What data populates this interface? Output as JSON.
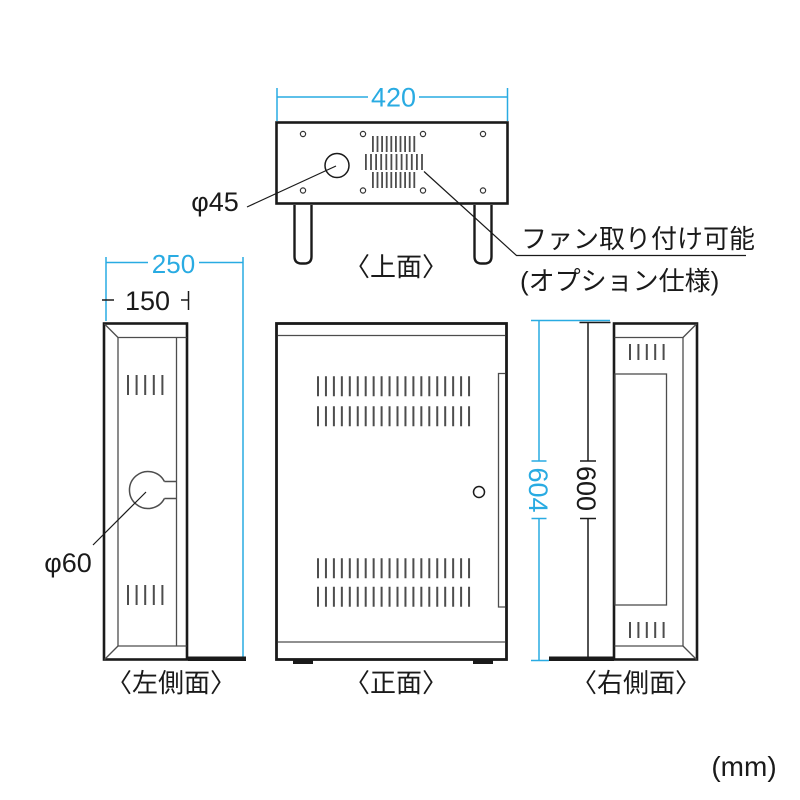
{
  "unit_label": "(mm)",
  "colors": {
    "dimension_accent": "#29abe2",
    "line_black": "#1a1a1a",
    "line_gray": "#4d4d4d",
    "background": "#ffffff"
  },
  "top_view": {
    "label": "〈上面〉",
    "dim_width": "420",
    "hole_label": "φ45",
    "fan_note_line1": "ファン取り付け可能",
    "fan_note_line2": "(オプション仕様)"
  },
  "left_view": {
    "label": "〈左側面〉",
    "dim_depth_total": "250",
    "dim_depth_body": "150",
    "hole_label": "φ60"
  },
  "front_view": {
    "label": "〈正面〉"
  },
  "right_view": {
    "label": "〈右側面〉",
    "dim_height_total": "604",
    "dim_height_body": "600"
  }
}
